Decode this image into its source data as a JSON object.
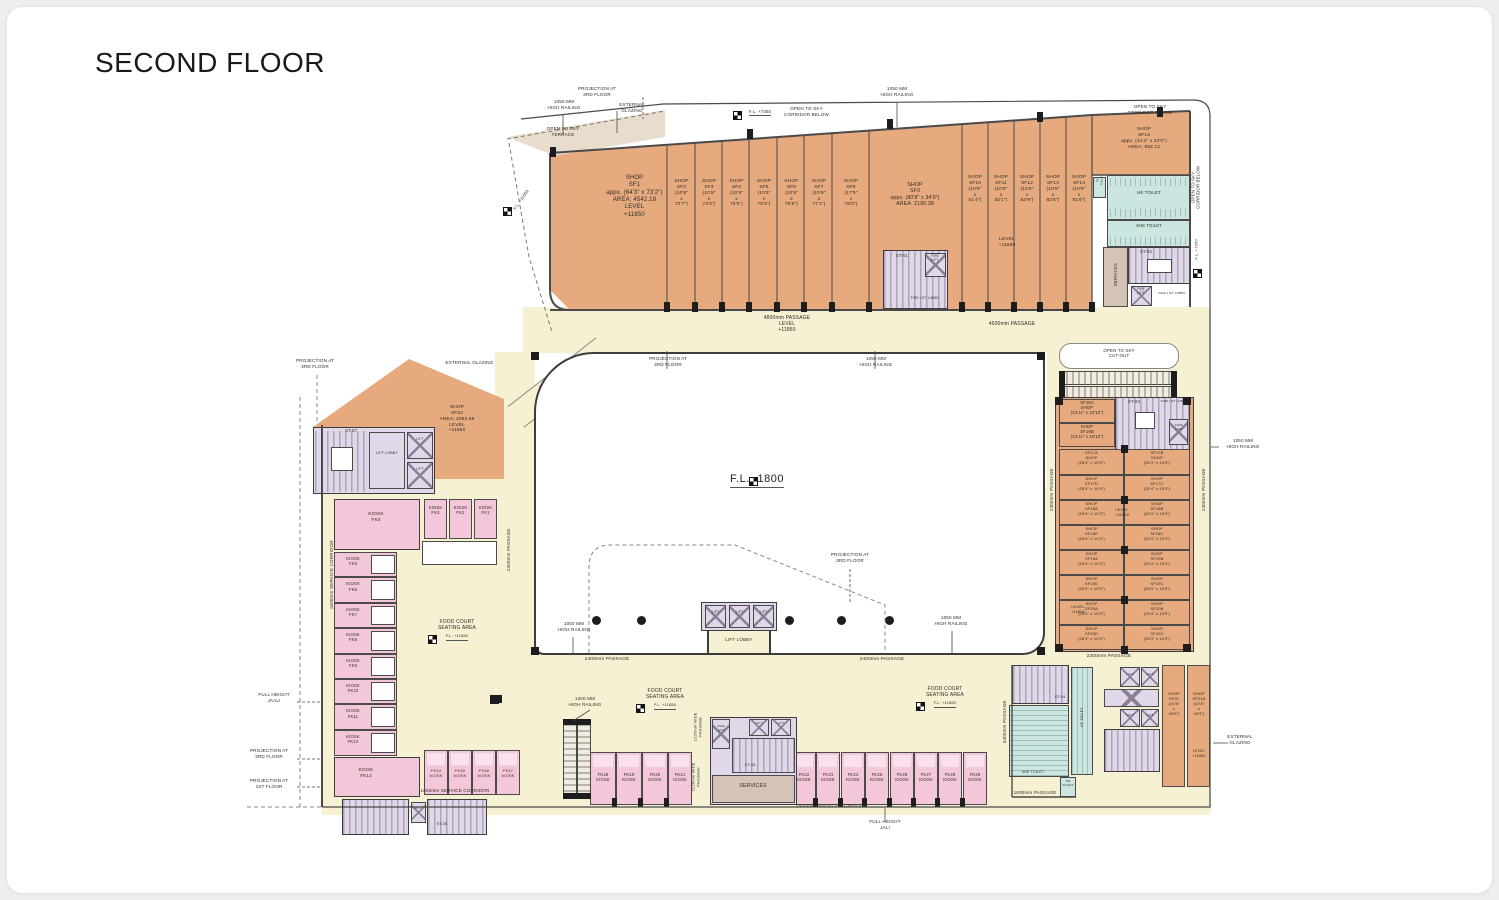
{
  "title": "SECOND FLOOR",
  "shops": {
    "sf1": [
      "SHOP",
      "SF1",
      "appx. (64'3\" x 73'2\")",
      "AREA: 4542.19",
      "LEVEL",
      "+11850"
    ],
    "top_row_a": [
      {
        "lines": [
          "SHOP",
          "SF2",
          "(10'9\"",
          "x",
          "73'7\")"
        ]
      },
      {
        "lines": [
          "SHOP",
          "SF3",
          "(10'9\"",
          "x",
          "74'3\")"
        ]
      },
      {
        "lines": [
          "SHOP",
          "SF4",
          "(10'9\"",
          "x",
          "75'0\")"
        ]
      },
      {
        "lines": [
          "SHOP",
          "SF5",
          "(10'9\"",
          "x",
          "75'8\")"
        ]
      },
      {
        "lines": [
          "SHOP",
          "SF6",
          "(10'9\"",
          "x",
          "76'5\")"
        ]
      },
      {
        "lines": [
          "SHOP",
          "SF7",
          "(10'9\"",
          "x",
          "77'1\")"
        ]
      },
      {
        "lines": [
          "SHOP",
          "SF8",
          "(17'9\"",
          "x",
          "78'0\")"
        ]
      }
    ],
    "sf9": [
      "SHOP",
      "SF9",
      "appx. (80'8\" x 34'0\")",
      "AREA: 2190.38"
    ],
    "top_row_b": [
      {
        "lines": [
          "SHOP",
          "SF10",
          "(10'9\"",
          "x",
          "81'4\")"
        ]
      },
      {
        "lines": [
          "SHOP",
          "SF11",
          "(10'9\"",
          "x",
          "82'1\")"
        ]
      },
      {
        "lines": [
          "SHOP",
          "SF12",
          "(10'9\"",
          "x",
          "82'9\")"
        ]
      },
      {
        "lines": [
          "SHOP",
          "SF13",
          "(10'9\"",
          "x",
          "82'6\")"
        ]
      },
      {
        "lines": [
          "SHOP",
          "SF14",
          "(10'9\"",
          "x",
          "81'6\")"
        ]
      }
    ],
    "strip_level": [
      "LEVEL",
      "+11850"
    ],
    "sf15": [
      "SHOP",
      "SF15",
      "appx. (41'4\" x 23'0\")",
      "AREA: 952.12"
    ],
    "sf16a": [
      "SF16A",
      "SHOP",
      "(23'11\" x 10'10\")"
    ],
    "sf16b": [
      "SHOP",
      "SF16B",
      "(23'11\" x 10'10\")"
    ],
    "right_rows": [
      [
        [
          "SF17A",
          "SHOP",
          "(28'4\" x 10'9\")"
        ],
        [
          "SF17B",
          "SHOP",
          "(28'4\" x 10'9\")"
        ]
      ],
      [
        [
          "SHOP",
          "SF17D",
          "(28'4\" x 10'9\")"
        ],
        [
          "SHOP",
          "SF17C",
          "(28'4\" x 10'9\")"
        ]
      ],
      [
        [
          "SHOP",
          "SF18A",
          "(28'4\" x 10'9\")"
        ],
        [
          "SHOP",
          "SF18B",
          "(28'4\" x 10'9\")"
        ]
      ],
      [
        [
          "SHOP",
          "SF18D",
          "(28'4\" x 10'9\")"
        ],
        [
          "SHOP",
          "SF18C",
          "(28'4\" x 10'9\")"
        ]
      ],
      [
        [
          "SHOP",
          "SF19A",
          "(28'4\" x 10'9\")"
        ],
        [
          "SHOP",
          "SF19B",
          "(28'4\" x 10'9\")"
        ]
      ],
      [
        [
          "SHOP",
          "SF19D",
          "(28'4\" x 10'9\")"
        ],
        [
          "SHOP",
          "SF19C",
          "(28'4\" x 10'9\")"
        ]
      ],
      [
        [
          "SHOP",
          "SF20A",
          "(28'4\" x 10'9\")"
        ],
        [
          "SHOP",
          "SF20B",
          "(28'4\" x 10'9\")"
        ]
      ],
      [
        [
          "SHOP",
          "SF20D",
          "(28'4\" x 10'9\")"
        ],
        [
          "SHOP",
          "SF20C",
          "(28'4\" x 10'9\")"
        ]
      ]
    ],
    "grid_level": [
      "LEVEL",
      "+11850"
    ],
    "sf21": [
      "SHOP",
      "SF21",
      "(10'8\"",
      "x",
      "45'9\")"
    ],
    "sf21a": [
      "SHOP",
      "SF21A",
      "(10'8\"",
      "x",
      "45'9\")"
    ],
    "sf21_level": [
      "LEVEL",
      "+11850"
    ],
    "sf22": [
      "SHOP",
      "SF22",
      "AREA: 2062.68",
      "LEVEL",
      "+11850"
    ]
  },
  "kiosks": {
    "word": "KIOSK",
    "fk4": [
      "KIOSK",
      "FK4"
    ],
    "top_row": [
      [
        "KIOSK",
        "FK3"
      ],
      [
        "KIOSK",
        "FK2"
      ],
      [
        "KIOSK",
        "FK1"
      ]
    ],
    "left_col": [
      [
        "KIOSK",
        "FK5"
      ],
      [
        "KIOSK",
        "FK6"
      ],
      [
        "KIOSK",
        "FK7"
      ],
      [
        "KIOSK",
        "FK8"
      ],
      [
        "KIOSK",
        "FK9"
      ],
      [
        "KIOSK",
        "FK10"
      ],
      [
        "KIOSK",
        "FK11"
      ],
      [
        "KIOSK",
        "FK12"
      ]
    ],
    "fk13": [
      "KIOSK",
      "FK13"
    ],
    "left_row": [
      [
        "FK14",
        "KIOSK"
      ],
      [
        "FK15",
        "KIOSK"
      ],
      [
        "FK16",
        "KIOSK"
      ],
      [
        "FK17",
        "KIOSK"
      ]
    ],
    "bottom_row1": [
      [
        "FK18",
        "KIOSK"
      ],
      [
        "FK19",
        "KIOSK"
      ],
      [
        "FK20",
        "KIOSK"
      ],
      [
        "FK21",
        "KIOSK"
      ]
    ],
    "bottom_row2": [
      [
        "FK22",
        "KIOSK"
      ],
      [
        "FK23",
        "KIOSK"
      ],
      [
        "FK24",
        "KIOSK"
      ],
      [
        "FK25",
        "KIOSK"
      ],
      [
        "FK26",
        "KIOSK"
      ],
      [
        "FK27",
        "KIOSK"
      ],
      [
        "FK28",
        "KIOSK"
      ],
      [
        "FK29",
        "KIOSK"
      ]
    ]
  },
  "facilities": {
    "st01": "ST-01",
    "st02": "ST-02",
    "st03": "ST-03",
    "st04": "ST-04",
    "st05": "ST-05",
    "st06": "ST-06",
    "st07": "ST-07",
    "he_toilet": "HE TOILET",
    "she_toilet": "SHE TOILET",
    "ph_toilet": [
      "PH",
      "TOILET"
    ],
    "services": "SERVICES",
    "lift": "LIFT",
    "lift_lobby": "LIFT LOBBY",
    "fire_lift": [
      "FIRE",
      "LIFT"
    ],
    "fire_lift_lobby": "FIRE LIFT LOBBY"
  },
  "passages": {
    "p4800": [
      "4800mm PASSAGE",
      "LEVEL",
      "+11850"
    ],
    "p4600": "4600mm PASSAGE",
    "p2400": "2400mm PASSAGE",
    "p2200": "2200mm PASSAGE",
    "p3400": "3400mm PASSAGE",
    "p1600": "1600mm PASSAGE",
    "sc1500": "1500mm SERVICE CORRIDOR",
    "sc1600": "1600mm SERVICE CORRIDOR",
    "wp2125": [
      "2125mm WIDE",
      "PASSAGE"
    ],
    "wp2225": [
      "2225mm WIDE",
      "PASSAGE"
    ]
  },
  "annotations": {
    "projection_3rd": [
      "PROJECTION AT",
      "3RD FLOOR"
    ],
    "projection_1st": [
      "PROJECTION AT",
      "1ST FLOOR"
    ],
    "railing_1050": [
      "1050 MM",
      "HIGH RAILING"
    ],
    "railing_1200": [
      "1200 MM",
      "HIGH RAILING"
    ],
    "ext_glazing2": [
      "EXTERNAL",
      "GLAZING"
    ],
    "ext_glazing1": [
      "EXTERNAL GLAZING"
    ],
    "open_sky_terrace": [
      "OPEN TO SKY",
      "TERRACE"
    ],
    "open_sky_corridor": [
      "OPEN TO SKY",
      "CORRIDOR BELOW"
    ],
    "open_sky_cutout": [
      "OPEN TO SKY",
      "CUT-OUT"
    ],
    "bridge": [
      "3400mm BRIDGE",
      "OPEN TO SKY"
    ],
    "fl_7350": "F.L. +7350",
    "fl_11850": "F.L. +11850",
    "fl_1800": "F.L. -1800",
    "full_height_jaali": [
      "FULL HEIGHT",
      "JAALI"
    ],
    "full_height_jali": [
      "FULL HEIGHT",
      "JALI"
    ],
    "food_court": [
      "FOOD COURT",
      "SEATING AREA"
    ],
    "food_court_fl": "F.L. +11850"
  },
  "colors": {
    "shop": "#e6aa7e",
    "kiosk": "#f3c6d9",
    "passage": "#f6f1d2",
    "toilet": "#cbe6e0",
    "stair": "#e0d7e8",
    "services": "#d5c3b6",
    "terrace": "#e5d8c6",
    "wall": "#3c3c3c"
  }
}
